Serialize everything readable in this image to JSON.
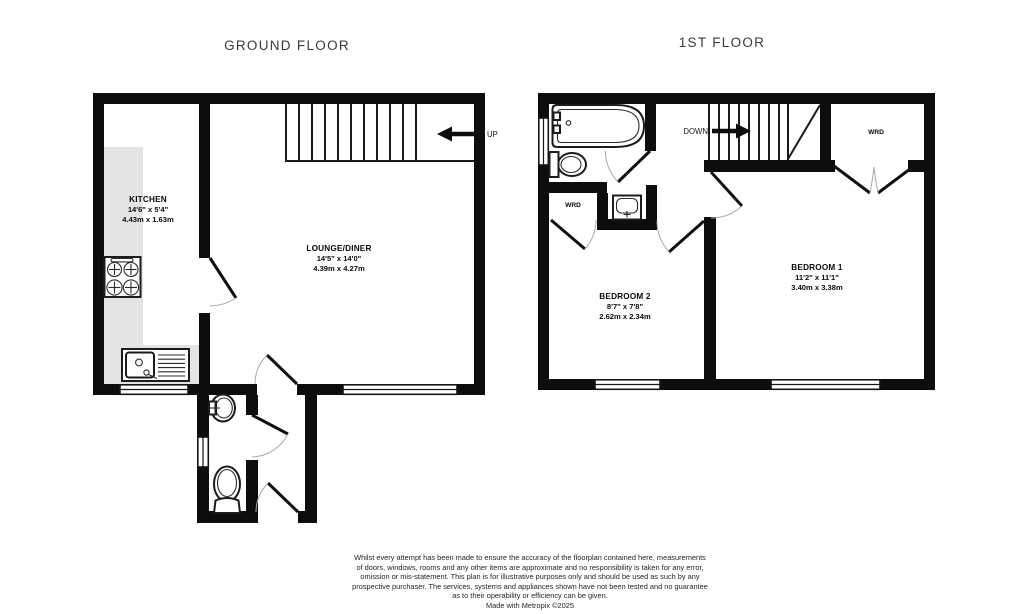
{
  "titles": {
    "ground_floor": "GROUND FLOOR",
    "first_floor": "1ST FLOOR"
  },
  "ground_floor": {
    "kitchen": {
      "name": "KITCHEN",
      "imperial": "14'6\" x 5'4\"",
      "metric": "4.43m x 1.63m"
    },
    "lounge": {
      "name": "LOUNGE/DINER",
      "imperial": "14'5\" x 14'0\"",
      "metric": "4.39m x 4.27m"
    },
    "stairs_label": "UP"
  },
  "first_floor": {
    "bedroom1": {
      "name": "BEDROOM 1",
      "imperial": "11'2\" x 11'1\"",
      "metric": "3.40m x 3.38m"
    },
    "bedroom2": {
      "name": "BEDROOM 2",
      "imperial": "8'7\" x 7'8\"",
      "metric": "2.62m x 2.34m"
    },
    "wardrobe1_label": "WRD",
    "wardrobe2_label": "WRD",
    "stairs_label": "DOWN"
  },
  "disclaimer": {
    "lines": [
      "Whilst every attempt has been made to ensure the accuracy of the floorplan contained here, measurements",
      "of doors, windows, rooms and any other items are approximate and no responsibility is taken for any error,",
      "omission or mis-statement. This plan is for illustrative purposes only and should be used as such by any",
      "prospective purchaser. The services, systems and appliances shown have not been tested and no guarantee",
      "as to their operability or efficiency can be given.",
      "Made with Metropix ©2025"
    ]
  },
  "colors": {
    "wall": "#0d0d0d",
    "counter": "#e4e4e4",
    "door_arc": "#a9a9a9",
    "title_text": "#3a3a3a",
    "background": "#ffffff"
  }
}
